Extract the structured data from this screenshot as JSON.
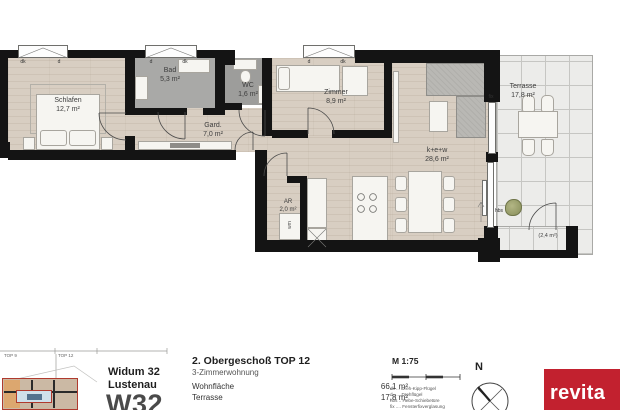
{
  "plan": {
    "rooms": [
      {
        "name": "Schlafen",
        "area": "12,7 m²"
      },
      {
        "name": "Bad",
        "area": "5,3 m²"
      },
      {
        "name": "WC",
        "area": "1,6 m²"
      },
      {
        "name": "Gard.",
        "area": "7,0 m²"
      },
      {
        "name": "Zimmer",
        "area": "8,9 m²"
      },
      {
        "name": "AR",
        "area": "2,0 m²"
      },
      {
        "name": "k+e+w",
        "area": "28,6 m²"
      },
      {
        "name": "Terrasse",
        "area": "17,8 m²"
      }
    ],
    "annotations": {
      "small_terrace": "(2,4 m²)",
      "wm": "wm",
      "hbs": "hbs",
      "fix": "fix"
    },
    "windows": [
      {
        "left": "dk",
        "right": "d"
      },
      {
        "left": "d",
        "right": "dk"
      },
      {
        "left": "d",
        "right": "dk"
      }
    ]
  },
  "titleblock": {
    "overview": {
      "top9": "TOP 9",
      "top12": "TOP 12"
    },
    "project": {
      "line1": "Widum 32",
      "line2": "Lustenau",
      "code": "W32"
    },
    "unit": {
      "title": "2. Obergeschoß TOP 12",
      "subtitle": "3-Zimmerwohnung",
      "metrics": [
        {
          "label": "Wohnfläche",
          "value": "66,1 m²"
        },
        {
          "label": "Terrasse",
          "value": "17,8 m²"
        }
      ]
    },
    "scale": {
      "label": "M 1:75"
    },
    "legend": [
      "dk ... Dreh-Kipp-Flügel",
      "d ..... Drehflügel",
      "hbs .. Hebe-Schiebetüre",
      "fix .... Fensterfixverglasung"
    ],
    "compass": {
      "north": "N"
    },
    "brand": {
      "logo": "revita"
    }
  },
  "colors": {
    "wall": "#141414",
    "wood": "#d8cec2",
    "bath": "#a9a9a7",
    "terrace": "#ececea",
    "brand_red": "#c2212f"
  }
}
